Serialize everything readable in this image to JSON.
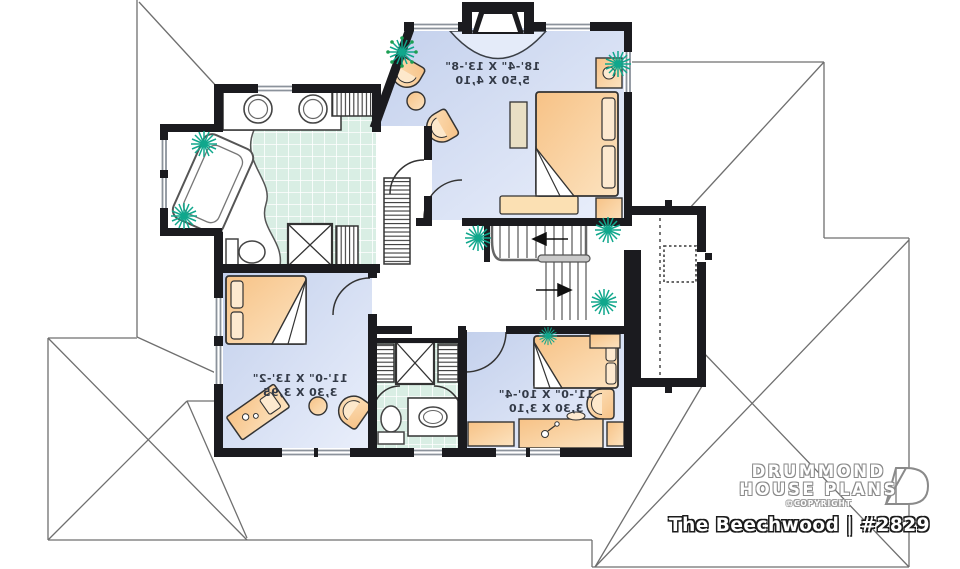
{
  "branding": {
    "line1": "DRUMMOND",
    "line2": "HOUSE PLANS",
    "copyright": "©COPYRIGHT",
    "plan_title": "The Beechwood | #2829"
  },
  "rooms": {
    "master_bedroom": {
      "imperial": "18'-4\" X 13'-8\"",
      "metric": "5,50 X 4,10"
    },
    "bedroom_2": {
      "imperial": "11'-0\" X 13'-2\"",
      "metric": "3,30 X 3,95"
    },
    "bedroom_3": {
      "imperial": "11'-0\" X 10'-4\"",
      "metric": "3,30 X 3,10"
    }
  },
  "colors": {
    "wall": "#1b1b1f",
    "bedroom_floor_start": "#c3d0ec",
    "bedroom_floor_end": "#eaeffb",
    "tile_floor": "#d9eee4",
    "furniture": "#f8c98e",
    "plant": "#10a78c",
    "roof_line": "#6f6f6f"
  }
}
